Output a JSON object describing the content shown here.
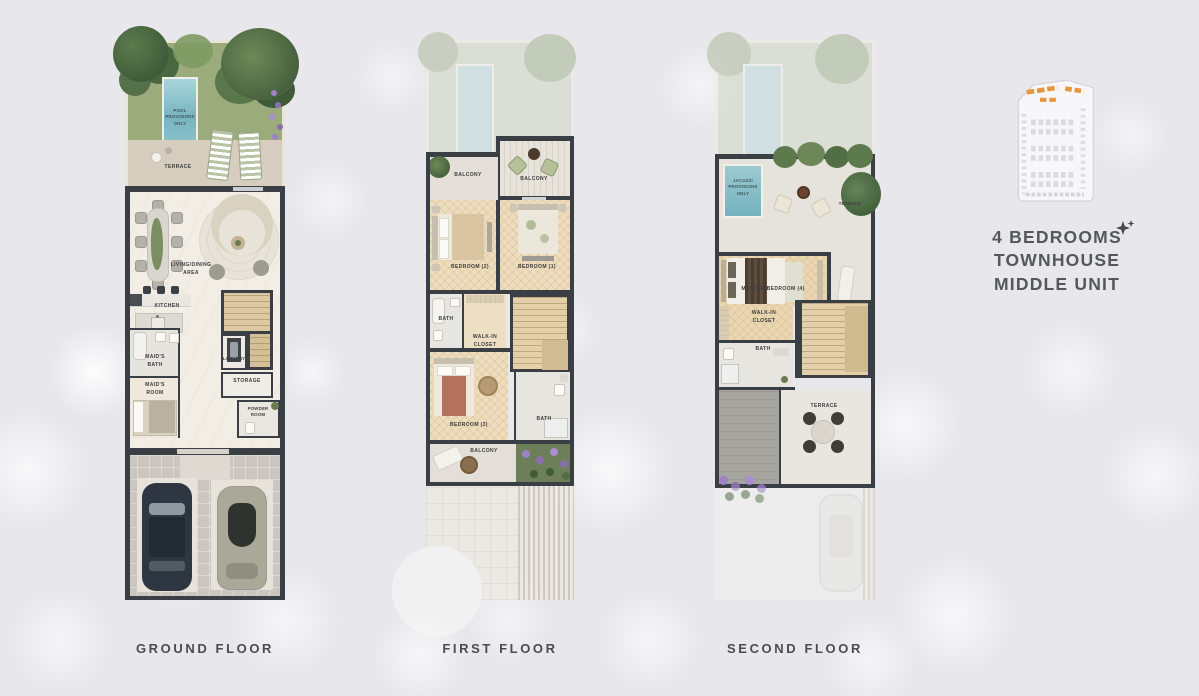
{
  "legend": {
    "lines": [
      "4 BEDROOMS",
      "TOWNHOUSE",
      "MIDDLE UNIT"
    ]
  },
  "colors": {
    "accent_orange": "#E8953F",
    "wall_dark": "#3A3F46",
    "pool_blue": "#79B6C1",
    "grass_green": "#9CAB7C",
    "title_text": "#56575B"
  },
  "floors": {
    "ground": {
      "caption": "GROUND FLOOR",
      "labels": {
        "pool": "POOL\nPROVISIONS\nONLY",
        "terrace": "TERRACE",
        "living": "LIVING/DINING\nAREA",
        "kitchen": "KITCHEN",
        "laundry": "LAUNDRY",
        "storage": "STORAGE",
        "maids_bath": "MAID'S\nBATH",
        "maids_room": "MAID'S\nROOM",
        "powder": "POWDER\nROOM"
      }
    },
    "first": {
      "caption": "FIRST FLOOR",
      "labels": {
        "balcony_left": "BALCONY",
        "balcony_right": "BALCONY",
        "bedroom2": "BEDROOM (2)",
        "bedroom1": "BEDROOM (1)",
        "bath_left": "BATH",
        "walkin": "WALK-IN\nCLOSET",
        "bedroom3": "BEDROOM (3)",
        "bath_right": "BATH",
        "balcony_bottom": "BALCONY"
      }
    },
    "second": {
      "caption": "SECOND FLOOR",
      "labels": {
        "jacuzzi": "JACUZZI\nPROVISIONS\nONLY",
        "terrace_top": "TERRACE",
        "master": "MASTER BEDROOM (4)",
        "walkin": "WALK-IN\nCLOSET",
        "bath": "BATH",
        "terrace_low": "TERRACE"
      }
    }
  }
}
